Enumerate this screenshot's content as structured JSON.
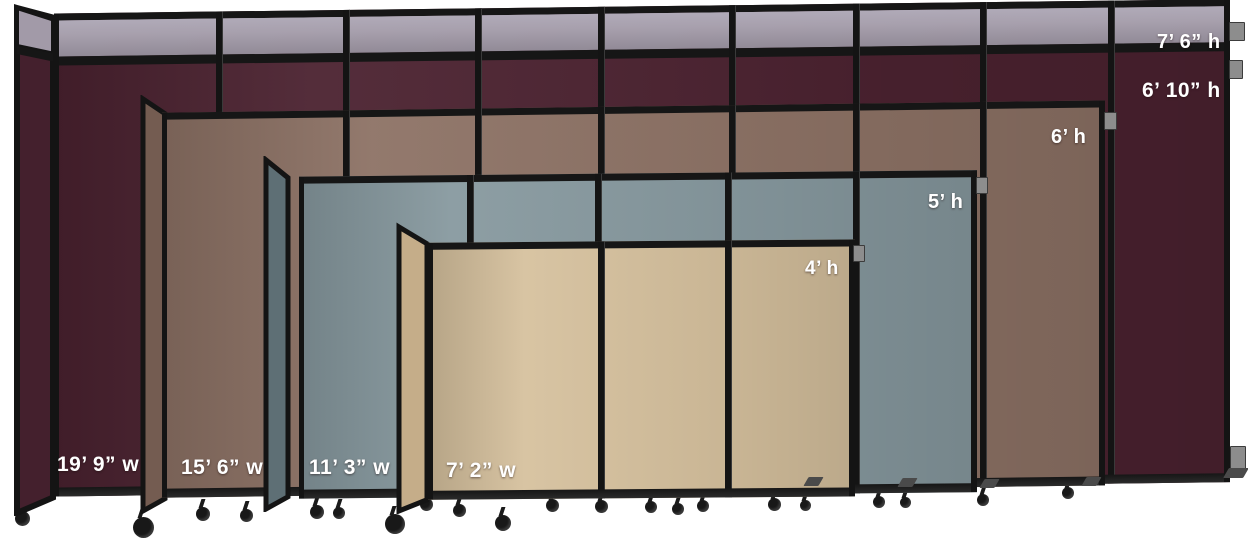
{
  "scene": {
    "title": "Portable room divider size comparison",
    "background": "#ffffff",
    "frame_color": "#161616",
    "label_color": "#ffffff",
    "partitions": [
      {
        "name": "burgundy tall partition",
        "body_color": "#4b2230",
        "return_color": "#44202d",
        "topper_color": "#a29aa8",
        "topper_height_label": "7’ 6” h",
        "body_height_label": "6’ 10” h",
        "width_label": "19’ 9” w",
        "panel_count": 9
      },
      {
        "name": "brown partition",
        "body_color": "#8d7265",
        "return_color": "#745c51",
        "height_label": "6’ h",
        "width_label": "15’ 6” w",
        "panel_count": 7
      },
      {
        "name": "slate blue partition",
        "body_color": "#87999f",
        "return_color": "#5e6f75",
        "height_label": "5’ h",
        "width_label": "11’ 3” w",
        "panel_count": 5
      },
      {
        "name": "beige partition",
        "body_color": "#d6c19e",
        "return_color": "#c5ad89",
        "height_label": "4’ h",
        "width_label": "7’ 2” w",
        "panel_count": 3
      }
    ]
  }
}
